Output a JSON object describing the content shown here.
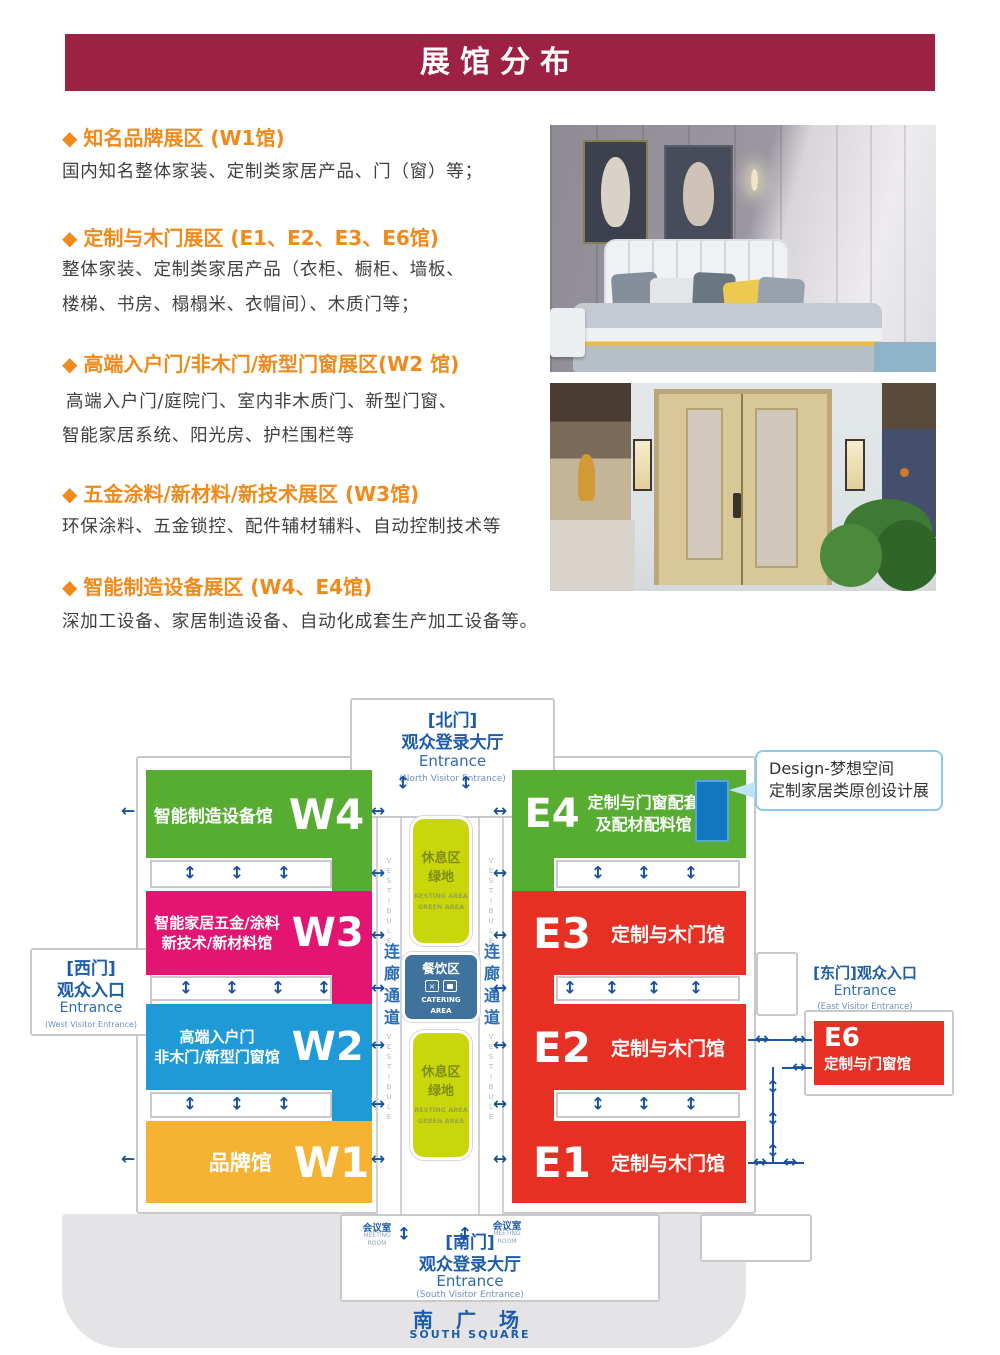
{
  "banner": {
    "title": "展馆分布"
  },
  "icons": {
    "bullet": "◆"
  },
  "sections": [
    {
      "heading": "知名品牌展区 (W1馆)",
      "lines": [
        "国内知名整体家装、定制类家居产品、门（窗）等；",
        ""
      ]
    },
    {
      "heading": "定制与木门展区 (E1、E2、E3、E6馆)",
      "lines": [
        "整体家装、定制类家居产品（衣柜、橱柜、墙板、",
        "楼梯、书房、榻榻米、衣帽间）、木质门等；"
      ]
    },
    {
      "heading": "高端入户门/非木门/新型门窗展区(W2 馆)",
      "lines": [
        "高端入户门/庭院门、室内非木质门、新型门窗、",
        "智能家居系统、阳光房、护栏围栏等"
      ]
    },
    {
      "heading": "五金涂料/新材料/新技术展区 (W3馆)",
      "lines": [
        "环保涂料、五金锁控、配件辅材辅料、自动控制技术等",
        ""
      ]
    },
    {
      "heading": "智能制造设备展区 (W4、E4馆)",
      "lines": [
        "深加工设备、家居制造设备、自动化成套生产加工设备等。",
        ""
      ]
    }
  ],
  "map": {
    "north": {
      "gate": "[北门]",
      "hall": "观众登录大厅",
      "entrance": "Entrance",
      "sub": "(North Visitor Entrance)"
    },
    "south": {
      "gate": "[南门]",
      "hall": "观众登录大厅",
      "entrance": "Entrance",
      "sub": "(South Visitor Entrance)",
      "square": "南 广 场",
      "square_en": "SOUTH   SQUARE",
      "meeting": "会议室",
      "meeting_en1": "MEETING",
      "meeting_en2": "ROOM"
    },
    "west": {
      "gate": "[西门]",
      "label": "观众入口",
      "entrance": "Entrance",
      "sub": "(West Visitor Entrance)"
    },
    "east": {
      "gate": "[东门]观众入口",
      "entrance": "Entrance",
      "sub": "(East Visitor Entrance)"
    },
    "halls": {
      "w4": {
        "code": "W4",
        "name": "智能制造设备馆",
        "color": "#56ad31"
      },
      "w3": {
        "code": "W3",
        "line1": "智能家居五金/涂料",
        "line2": "新技术/新材料馆",
        "color": "#e31472"
      },
      "w2": {
        "code": "W2",
        "line1": "高端入户门",
        "line2": "非木门/新型门窗馆",
        "color": "#1f9ad6"
      },
      "w1": {
        "code": "W1",
        "name": "品牌馆",
        "color": "#f5b233"
      },
      "e4": {
        "code": "E4",
        "line1": "定制与门窗配套",
        "line2": "及配材配料馆",
        "color": "#56ad31"
      },
      "e3": {
        "code": "E3",
        "name": "定制与木门馆",
        "color": "#e53023"
      },
      "e2": {
        "code": "E2",
        "name": "定制与木门馆",
        "color": "#e53023"
      },
      "e1": {
        "code": "E1",
        "name": "定制与木门馆",
        "color": "#e53023"
      },
      "e6": {
        "code": "E6",
        "name": "定制与门窗馆",
        "color": "#e53023"
      }
    },
    "center": {
      "rest1": "休息区",
      "rest2": "绿地",
      "rest_en1": "RESTING AREA",
      "rest_en2": "GREEN AREA",
      "catering": "餐饮区",
      "catering_en1": "CATERING",
      "catering_en2": "AREA",
      "corridor": "连廊通道",
      "vestibule": "VESTIBULE"
    },
    "callout": {
      "line1": "Design-梦想空间",
      "line2": "定制家居类原创设计展"
    }
  }
}
